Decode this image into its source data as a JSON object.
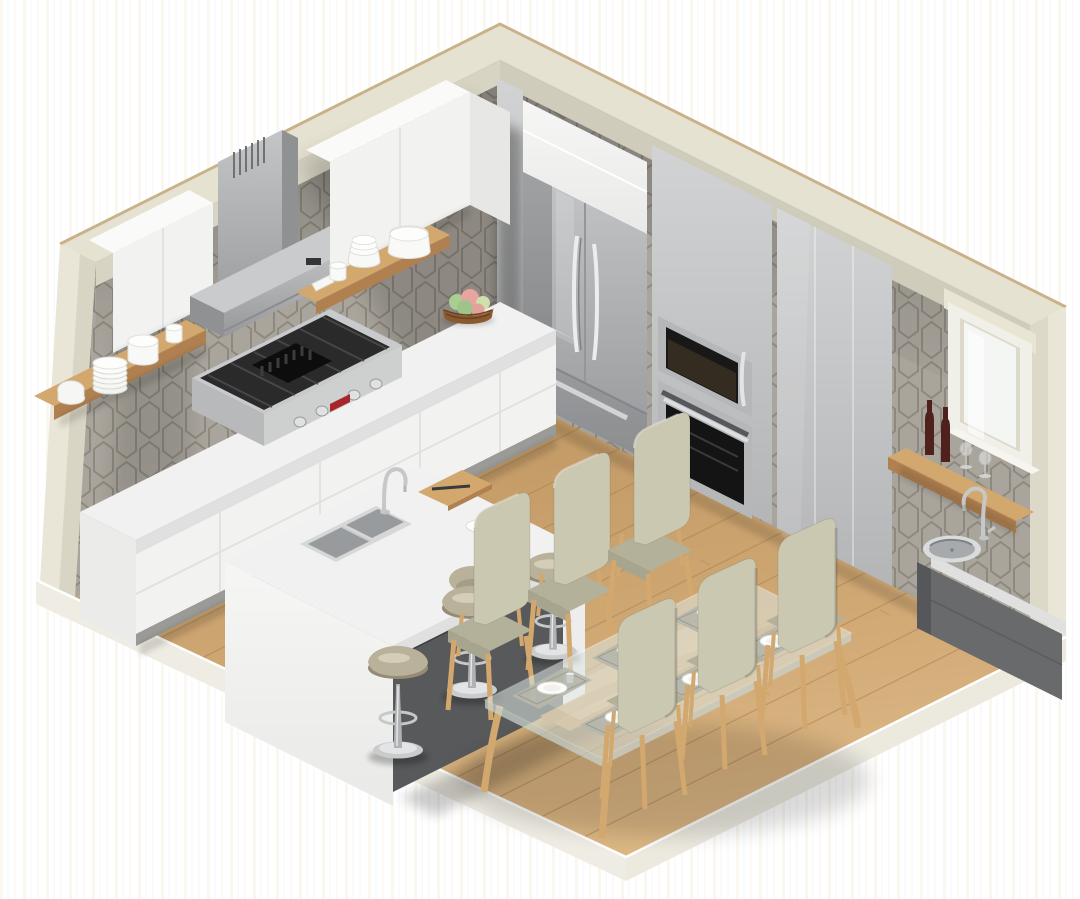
{
  "scene": {
    "title": "Isometric 3D cutaway rendering of a modern kitchen and dining room",
    "projection": "isometric cutaway",
    "room": "kitchen with dining area"
  },
  "colors": {
    "wall_top": "#e6e2d1",
    "wall_cap": "#c9b28a",
    "wall_end": "#eae6d7",
    "soffit": "#d8d4c4",
    "tile": "#a9a59c",
    "tile_grout": "#8e897f",
    "cabinet_white": "#f2f2f1",
    "cabinet_white_top": "#fafaf9",
    "cabinet_gray": "#c5c6c7",
    "steel": "#b5b7b9",
    "steel_dark": "#8f9193",
    "appliance_black": "#1b1b1b",
    "counter": "#f0f1f0",
    "counter_edge": "#dfe0df",
    "island_base": "#57595a",
    "charcoal": "#686a6c",
    "wood": "#d3a86f",
    "wood_dark": "#b08050",
    "floor_light": "#d9b582",
    "floor_dark": "#bb9260",
    "slab": "#efede3",
    "glass": "#dce6e1",
    "chair_fabric": "#cbc8b1",
    "chair_fabric_dark": "#b4b19b",
    "stool_seat": "#b9b19a",
    "chrome": "#c6c8c9",
    "wine": "#4e211d",
    "plate": "#fdfdfc",
    "fruit_green": "#a8cf92",
    "fruit_pink": "#e8a49e",
    "fruit_pale": "#cfe0ac",
    "basket": "#8a5a2e",
    "badge_red": "#a8262b"
  },
  "left_wall": {
    "backsplash": "grey picket tile",
    "upper_cabinet_runs": 2,
    "floating_shelves": 2,
    "range_hood": "stainless chimney hood",
    "rangetop": {
      "finish": "stainless",
      "knobs": 4,
      "badge": "red logo plate",
      "griddle": true
    },
    "base_cabinets": "white gloss drawers",
    "countertop": "white quartz",
    "fruit_bowl": {
      "basket": "wicker",
      "fruits": [
        "green apples",
        "peaches",
        "pears"
      ]
    },
    "shelf_items": [
      "stack of plates",
      "round dish",
      "cup",
      "bowl stack",
      "serving bowl"
    ]
  },
  "right_wall": {
    "refrigerator": {
      "type": "french-door",
      "finish": "stainless",
      "door_handles": 2,
      "freezer_drawer": true
    },
    "built_in_microwave": 1,
    "wall_oven": 1,
    "tall_cabinets": "grey gloss floor-to-ceiling",
    "window": 1,
    "wine_shelf": {
      "bottles": 2,
      "glasses": 2
    },
    "prep_sink": {
      "faucet": "chrome gooseneck",
      "base_cabinet": "charcoal"
    }
  },
  "island": {
    "countertop": "white quartz waterfall",
    "base": "dark grey recessed",
    "sink": "double undermount stainless",
    "faucet": "chrome gooseneck",
    "cutting_board": 1,
    "plates": 2
  },
  "seating": {
    "bar_stools": 3,
    "bar_stool_style": "adjustable pedestal stool, champagne seat, chrome base",
    "dining_chairs": 6,
    "chair_style": "beige upholstered with oak legs"
  },
  "dining_table": {
    "top": "glass",
    "base": "curved oak",
    "place_settings": 6,
    "place_setting_items": [
      "woven placemat",
      "white plate",
      "glass tumbler"
    ]
  },
  "floor": "oak plank"
}
